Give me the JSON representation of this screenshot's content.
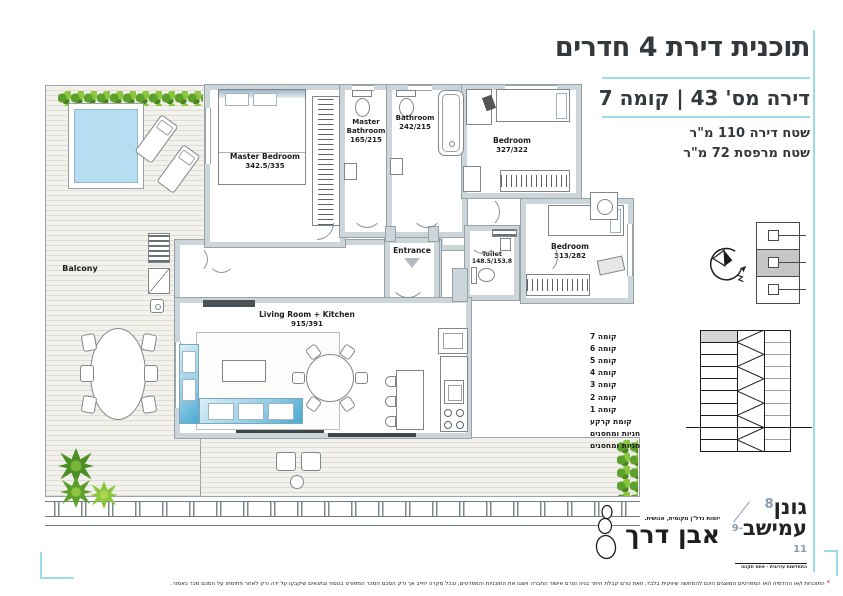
{
  "accent": {
    "cyan": "#9bdce9",
    "wall_gray": "#ccd5da",
    "pool_blue": "#b6ddf1",
    "sofa_blue": "#49a8d1",
    "hedge_green": "#8cc63f",
    "red": "#e30613",
    "highlight_gray": "#d4d4d4"
  },
  "title_block": {
    "title": "תוכנית דירת 4 חדרים",
    "subtitle": "דירה מס' 43  |  קומה 7",
    "area_line1": "שטח דירה 110 מ\"ר",
    "area_line2": "שטח מרפסת 72 מ\"ר"
  },
  "plan": {
    "rooms": [
      {
        "name": "Master Bedroom",
        "dims": "342.5/335"
      },
      {
        "name": "Master Bathroom",
        "dims": "165/215"
      },
      {
        "name": "Bathroom",
        "dims": "242/215"
      },
      {
        "name": "Bedroom",
        "dims": "327/322"
      },
      {
        "name": "Bedroom",
        "dims": "313/282"
      },
      {
        "name": "Toilet",
        "dims": "148.5/153.8"
      },
      {
        "name": "Entrance",
        "dims": ""
      },
      {
        "name": "Living Room + Kitchen",
        "dims": "915/391"
      },
      {
        "name": "Balcony",
        "dims": ""
      }
    ]
  },
  "floor_diagram": {
    "floors": [
      "קומה 7",
      "קומה 6",
      "קומה 5",
      "קומה 4",
      "קומה 3",
      "קומה 2",
      "קומה 1",
      "קומת קרקע",
      "חניות ומחסנים",
      "חניות ומחסנים"
    ],
    "highlighted_floor": "קומה 7"
  },
  "logos": {
    "project": {
      "line1": "גונן",
      "line2": "עמישב",
      "num1": "8",
      "num2": "9-11",
      "tagline": "התחדשות עירונית ∙ פתח תקווה"
    },
    "developer": {
      "name": "אבן דרך",
      "tagline": "יזמות נדל\"ן מקומית, אנושית."
    }
  },
  "disclaimer": {
    "star": "*",
    "text": "התוכניות ו/או ההדמיה ו/או המפרטים המוצגים הינם להמחשה שיווקית בלבד, וזאת טרם קבלת היתר בניה וטרם אישור החברה ויוצגו את התוכניות והמפרטים, ובכל מקרה יחייב אך ורק הסכם המכר המפורט בנוסח ובתנאים שיקבעו על ידה ורק לאחר חתימתו על הסכם מכר כאמור."
  }
}
